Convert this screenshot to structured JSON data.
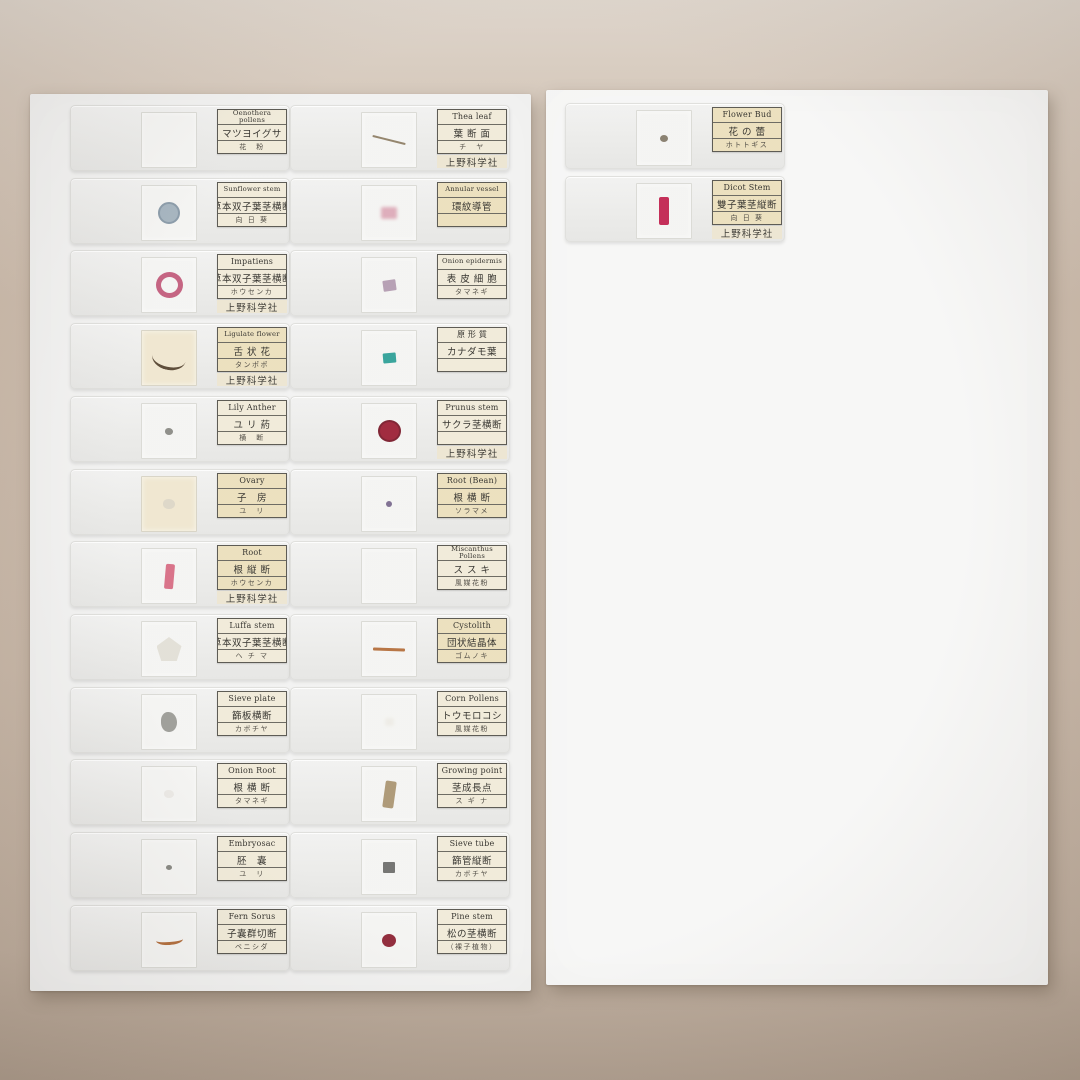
{
  "scene": {
    "description": "Photograph of prepared microscope slide sets on two white trays over a tan background",
    "maker_label": "上野科学社",
    "background_color": "#c8b7a7",
    "board_color": "#f2f2f1"
  },
  "boards": [
    {
      "id": "board-left",
      "columns": [
        [
          {
            "en": "Oenothera pollens",
            "jp": "マツヨイグサ",
            "sub": "花　粉",
            "maker": false,
            "tint": "cream",
            "glass": "white",
            "specimen": {
              "shape": "none"
            }
          },
          {
            "en": "Sunflower stem",
            "jp": "草本双子葉茎横断",
            "sub": "向 日 葵",
            "maker": false,
            "tint": "cream",
            "glass": "white",
            "specimen": {
              "shape": "circle",
              "color": "#a3b2bd",
              "edge": "#8798a6",
              "w": 22,
              "h": 22
            }
          },
          {
            "en": "Impatiens",
            "jp": "草本双子葉茎横断",
            "sub": "ホウセンカ",
            "maker": true,
            "tint": "cream",
            "glass": "white",
            "specimen": {
              "shape": "ring",
              "color": "#c25d7c",
              "w": 27,
              "h": 26
            }
          },
          {
            "en": "Ligulate flower",
            "jp": "舌 状 花",
            "sub": "タンポポ",
            "maker": true,
            "tint": "yellow",
            "glass": "cream",
            "specimen": {
              "shape": "arc",
              "color": "#564430",
              "w": 34,
              "h": 24,
              "rot": 12
            }
          },
          {
            "en": "Lily Anther",
            "jp": "ユ リ 葯",
            "sub": "横　断",
            "maker": false,
            "tint": "cream",
            "glass": "white",
            "specimen": {
              "shape": "blob",
              "color": "#8a8a85",
              "w": 8,
              "h": 7
            }
          },
          {
            "en": "Ovary",
            "jp": "子　房",
            "sub": "ユ　リ",
            "maker": false,
            "tint": "yellow",
            "glass": "cream",
            "specimen": {
              "shape": "blob",
              "color": "#d8d2c4",
              "w": 12,
              "h": 10,
              "opacity": 0.85
            }
          },
          {
            "en": "Root",
            "jp": "根 縦 断",
            "sub": "ホウセンカ",
            "maker": true,
            "tint": "yellow",
            "glass": "white",
            "specimen": {
              "shape": "bar",
              "color": "#d76d84",
              "w": 9,
              "h": 25,
              "rot": 5
            }
          },
          {
            "en": "Luffa stem",
            "jp": "草本双子葉茎横断",
            "sub": "ヘ チ マ",
            "maker": false,
            "tint": "cream",
            "glass": "white",
            "specimen": {
              "shape": "pentagon",
              "color": "#e2dfd6",
              "w": 25,
              "h": 24
            }
          },
          {
            "en": "Sieve plate",
            "jp": "篩板横断",
            "sub": "カボチヤ",
            "maker": false,
            "tint": "cream",
            "glass": "white",
            "specimen": {
              "shape": "blob",
              "color": "#9b9b96",
              "w": 16,
              "h": 20
            }
          },
          {
            "en": "Onion Root",
            "jp": "根 横 断",
            "sub": "タマネギ",
            "maker": false,
            "tint": "cream",
            "glass": "white",
            "specimen": {
              "shape": "blob",
              "color": "#e2e0da",
              "w": 10,
              "h": 8,
              "opacity": 0.6
            }
          },
          {
            "en": "Embryosac",
            "jp": "胚　嚢",
            "sub": "ユ　リ",
            "maker": false,
            "tint": "cream",
            "glass": "white",
            "specimen": {
              "shape": "dot",
              "color": "#85857f",
              "w": 6,
              "h": 5
            }
          },
          {
            "en": "Fern Sorus",
            "jp": "子嚢群切断",
            "sub": "ベニシダ",
            "maker": false,
            "tint": "cream",
            "glass": "white",
            "specimen": {
              "shape": "arc",
              "color": "#b06b39",
              "w": 27,
              "h": 10,
              "rot": -4
            }
          }
        ],
        [
          {
            "en": "Thea leaf",
            "jp": "葉 断 面",
            "sub": "チ　ヤ",
            "maker": true,
            "tint": "cream",
            "glass": "white",
            "specimen": {
              "shape": "line",
              "color": "#8f7f66",
              "w": 34,
              "h": 2,
              "rot": 14
            }
          },
          {
            "en": "Annular vessel",
            "jp": "環紋導管",
            "sub": "",
            "maker": false,
            "tint": "yellow",
            "glass": "white",
            "specimen": {
              "shape": "smudge",
              "color": "#dcaab8",
              "w": 16,
              "h": 12
            }
          },
          {
            "en": "Onion epidermis",
            "jp": "表 皮 細 胞",
            "sub": "タマネギ",
            "maker": false,
            "tint": "cream",
            "glass": "white",
            "specimen": {
              "shape": "square",
              "color": "#b39cb1",
              "w": 13,
              "h": 11,
              "rot": -8
            }
          },
          {
            "en": "原 形 質",
            "jp": "カナダモ葉",
            "sub": "",
            "maker": false,
            "tint": "cream",
            "glass": "white",
            "specimen": {
              "shape": "square",
              "color": "#2fa098",
              "w": 13,
              "h": 10,
              "rot": -5
            }
          },
          {
            "en": "Prunus stem",
            "jp": "サクラ茎横断",
            "sub": "",
            "maker": true,
            "tint": "cream",
            "glass": "white",
            "specimen": {
              "shape": "circle",
              "color": "#9c2136",
              "edge": "#7a1b2b",
              "w": 23,
              "h": 22
            }
          },
          {
            "en": "Root (Bean)",
            "jp": "根 横 断",
            "sub": "ソラマメ",
            "maker": false,
            "tint": "yellow",
            "glass": "white",
            "specimen": {
              "shape": "dot",
              "color": "#7a6a8e",
              "w": 6,
              "h": 6
            }
          },
          {
            "en": "Miscanthus Pollens",
            "jp": "ス ス キ",
            "sub": "風媒花粉",
            "maker": false,
            "tint": "cream",
            "glass": "white",
            "specimen": {
              "shape": "none"
            }
          },
          {
            "en": "Cystolith",
            "jp": "団状結晶体",
            "sub": "ゴムノキ",
            "maker": false,
            "tint": "yellow",
            "glass": "white",
            "specimen": {
              "shape": "line",
              "color": "#b46f3c",
              "w": 32,
              "h": 3,
              "rot": 2
            }
          },
          {
            "en": "Corn Pollens",
            "jp": "トウモロコシ",
            "sub": "風媒花粉",
            "maker": false,
            "tint": "cream",
            "glass": "white",
            "specimen": {
              "shape": "smudge",
              "color": "#e6e2d9",
              "w": 9,
              "h": 8,
              "opacity": 0.5
            }
          },
          {
            "en": "Growing point",
            "jp": "茎成長点",
            "sub": "ス ギ ナ",
            "maker": false,
            "tint": "cream",
            "glass": "white",
            "specimen": {
              "shape": "bar",
              "color": "#ab9673",
              "w": 11,
              "h": 27,
              "rot": 8
            }
          },
          {
            "en": "Sieve tube",
            "jp": "篩管縦断",
            "sub": "カボチヤ",
            "maker": false,
            "tint": "cream",
            "glass": "white",
            "specimen": {
              "shape": "square",
              "color": "#6f6f6d",
              "w": 12,
              "h": 11
            }
          },
          {
            "en": "Pine stem",
            "jp": "松の茎横断",
            "sub": "（裸子植物）",
            "maker": false,
            "tint": "cream",
            "glass": "white",
            "specimen": {
              "shape": "dot",
              "color": "#8d2334",
              "w": 14,
              "h": 13
            }
          }
        ]
      ]
    },
    {
      "id": "board-right",
      "columns": [
        [
          {
            "en": "Flower Bud",
            "jp": "花 の 蕾",
            "sub": "ホトトギス",
            "maker": false,
            "tint": "yellow",
            "glass": "white",
            "specimen": {
              "shape": "dot",
              "color": "#857b6b",
              "w": 8,
              "h": 7
            }
          },
          {
            "en": "Dicot Stem",
            "jp": "雙子葉茎縦断",
            "sub": "向 日 葵",
            "maker": true,
            "tint": "yellow",
            "glass": "white",
            "specimen": {
              "shape": "bar",
              "color": "#c12450",
              "w": 10,
              "h": 28
            }
          }
        ]
      ]
    }
  ]
}
